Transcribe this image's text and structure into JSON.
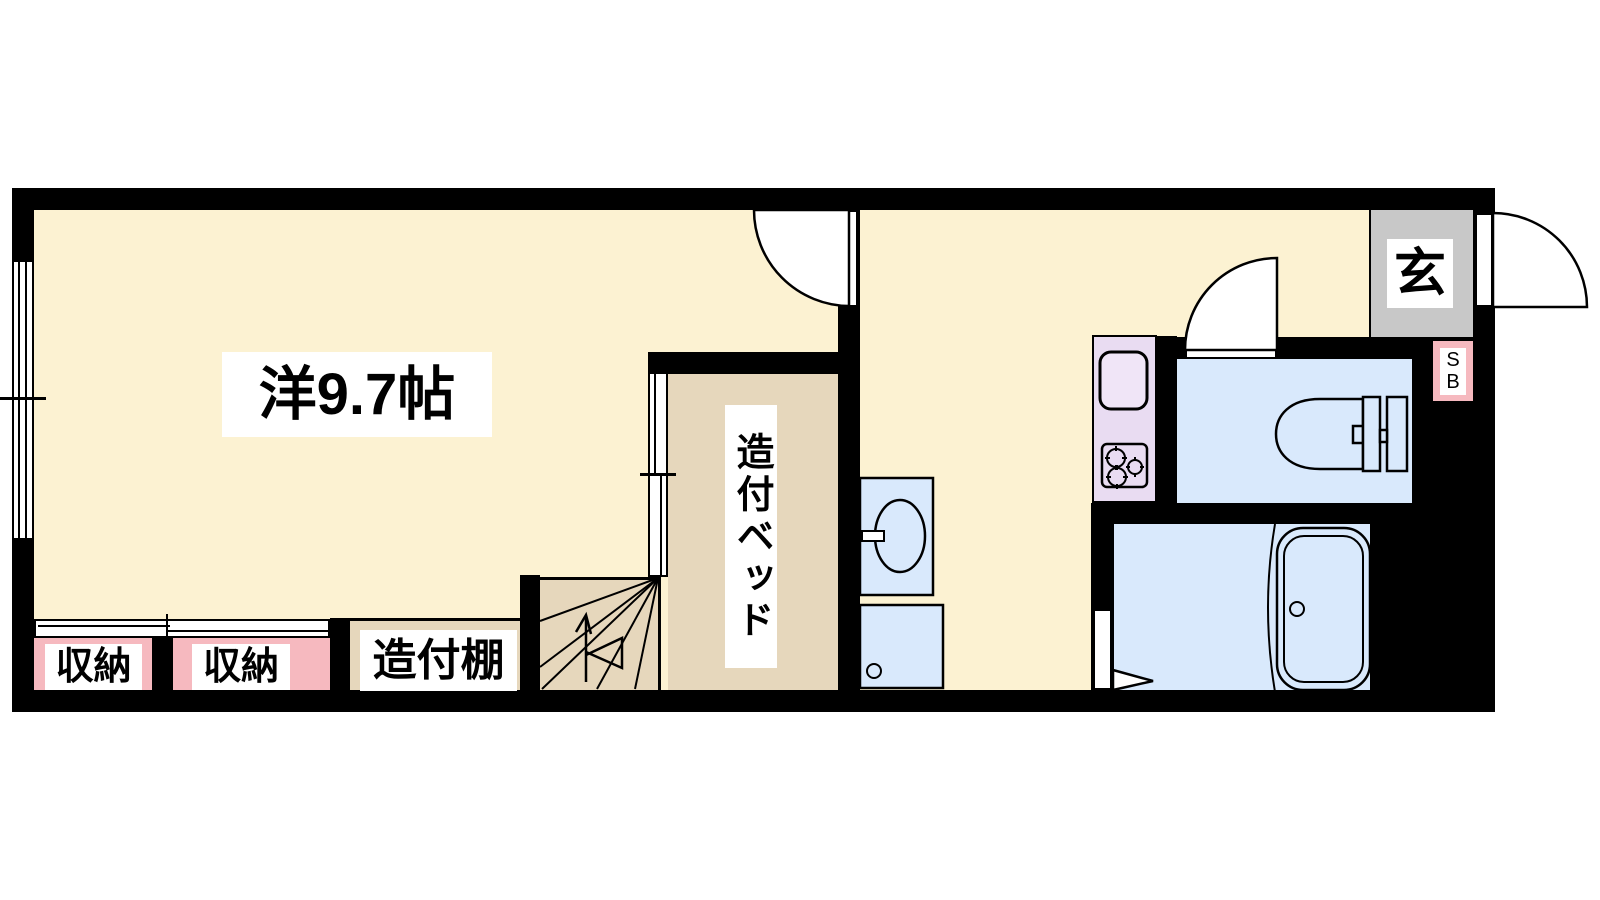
{
  "rooms": {
    "main": {
      "label": "洋9.7帖"
    },
    "bed": {
      "label": "造付ベッド"
    },
    "shelf": {
      "label": "造付棚"
    },
    "closet1": {
      "label": "収納"
    },
    "closet2": {
      "label": "収納"
    },
    "entrance": {
      "label": "玄"
    },
    "shoebox": {
      "line1": "S",
      "line2": "B"
    }
  },
  "colors": {
    "floor_cream": "#FCF2D2",
    "floor_tan": "#E6D7BC",
    "closet_pink": "#F6B9BF",
    "water_blue": "#D9E9FC",
    "counter_lavender": "#E9DCF2",
    "entrance_gray": "#C8C8C8",
    "wall_black": "#000000",
    "label_bg": "#FFFFFF"
  }
}
